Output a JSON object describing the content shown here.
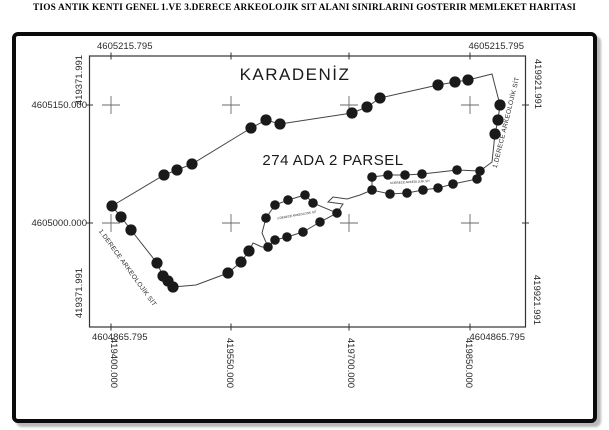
{
  "title": "TIOS ANTIK KENTI GENEL 1.VE 3.DERECE ARKEOLOJIK SIT ALANI SINIRLARINI GOSTERIR MEMLEKET HARITASI",
  "map": {
    "sea_label": "KARADENİZ",
    "parcel_label": "274 ADA 2 PARSEL",
    "boundary_label_right": "1.DERECE ARKEOLOJİK SİT",
    "boundary_label_left": "1.DERECE ARKEOLOJİK SİT",
    "inner_label_left": "3.DERECE ARKEOLOJİK SİT",
    "inner_label_right": "3.DERECE ARKEOLOJİK SİT",
    "coords": {
      "top_left": "4605215.795",
      "top_right": "4605215.795",
      "left_upper_rot": "419371.991",
      "left_lower_rot": "419371.991",
      "right_upper_rot": "419921.991",
      "right_lower_rot": "419921.991",
      "left_mid_upper": "4605150.000",
      "left_mid_lower": "4605000.000",
      "bottom_left": "4604865.795",
      "bottom_right": "4604865.795",
      "bottom_x_labels": [
        "419400.000",
        "419550.000",
        "419700.000",
        "419850.000"
      ]
    },
    "colors": {
      "line": "#444444",
      "dot": "#1a1a1a",
      "frame": "#333333",
      "cross": "#6a6a6a",
      "border": "#0b0b0b"
    }
  },
  "map_geometry": {
    "frame": {
      "x": 89.5,
      "y": 56,
      "w": 436,
      "h": 271
    },
    "crosses": [
      [
        111,
        105
      ],
      [
        231,
        105
      ],
      [
        349,
        105
      ],
      [
        470,
        105
      ],
      [
        111,
        223
      ],
      [
        231,
        223
      ],
      [
        349,
        223
      ],
      [
        470,
        223
      ]
    ],
    "tick_xs": [
      111,
      231,
      349,
      470
    ],
    "tick_ys": [
      105,
      223
    ],
    "paths": {
      "main_coast": "M112,206 L164,175 L177,170 L192,164 L251,128 L266,120 L280,124 L352,113 L367,107 L380,98 L438,85 L455,82 L468,80 L492,74 L500,105 L498,120 L495,134 L492,162 L480,171",
      "west_side": "M112,206 L121,217 L131,230 L157,263 L163,276 L168,281 L173,287 L196,285 L228,273 L241,262 L249,251 L253,243 L262,247 L268,247",
      "left_loop": "M268,247 L262,233 L266,218 L275,205 L288,200 L305,195 L313,203 L337,213 L320,222 L303,232 L287,237 L275,240 Z",
      "connector": "M337,213 L343,204 L328,202 L333,197 L347,199 L360,195 L372,190",
      "right_loop": "M480,171 L457,170 L440,172 L422,174 L405,175 L388,175 L372,177 L372,190 L390,194 L407,193 L423,190 L438,188 L453,184 L477,179 Z"
    },
    "dots_large": [
      [
        112,
        206
      ],
      [
        164,
        175
      ],
      [
        177,
        170
      ],
      [
        192,
        164
      ],
      [
        251,
        128
      ],
      [
        266,
        120
      ],
      [
        280,
        124
      ],
      [
        352,
        113
      ],
      [
        367,
        107
      ],
      [
        380,
        98
      ],
      [
        438,
        85
      ],
      [
        455,
        82
      ],
      [
        468,
        80
      ],
      [
        500,
        105
      ],
      [
        498,
        120
      ],
      [
        495,
        134
      ],
      [
        121,
        217
      ],
      [
        131,
        230
      ],
      [
        157,
        263
      ],
      [
        163,
        276
      ],
      [
        168,
        281
      ],
      [
        173,
        287
      ],
      [
        228,
        273
      ],
      [
        241,
        262
      ],
      [
        249,
        251
      ]
    ],
    "dots_small": [
      [
        372,
        177
      ],
      [
        388,
        175
      ],
      [
        405,
        175
      ],
      [
        422,
        174
      ],
      [
        457,
        170
      ],
      [
        480,
        171
      ],
      [
        372,
        190
      ],
      [
        390,
        194
      ],
      [
        407,
        193
      ],
      [
        423,
        190
      ],
      [
        438,
        188
      ],
      [
        453,
        184
      ],
      [
        477,
        179
      ],
      [
        266,
        218
      ],
      [
        275,
        205
      ],
      [
        288,
        200
      ],
      [
        305,
        195
      ],
      [
        313,
        203
      ],
      [
        337,
        213
      ],
      [
        320,
        222
      ],
      [
        303,
        232
      ],
      [
        287,
        237
      ],
      [
        275,
        240
      ],
      [
        268,
        247
      ]
    ],
    "dot_r_large": 5.6,
    "dot_r_small": 4.8
  }
}
